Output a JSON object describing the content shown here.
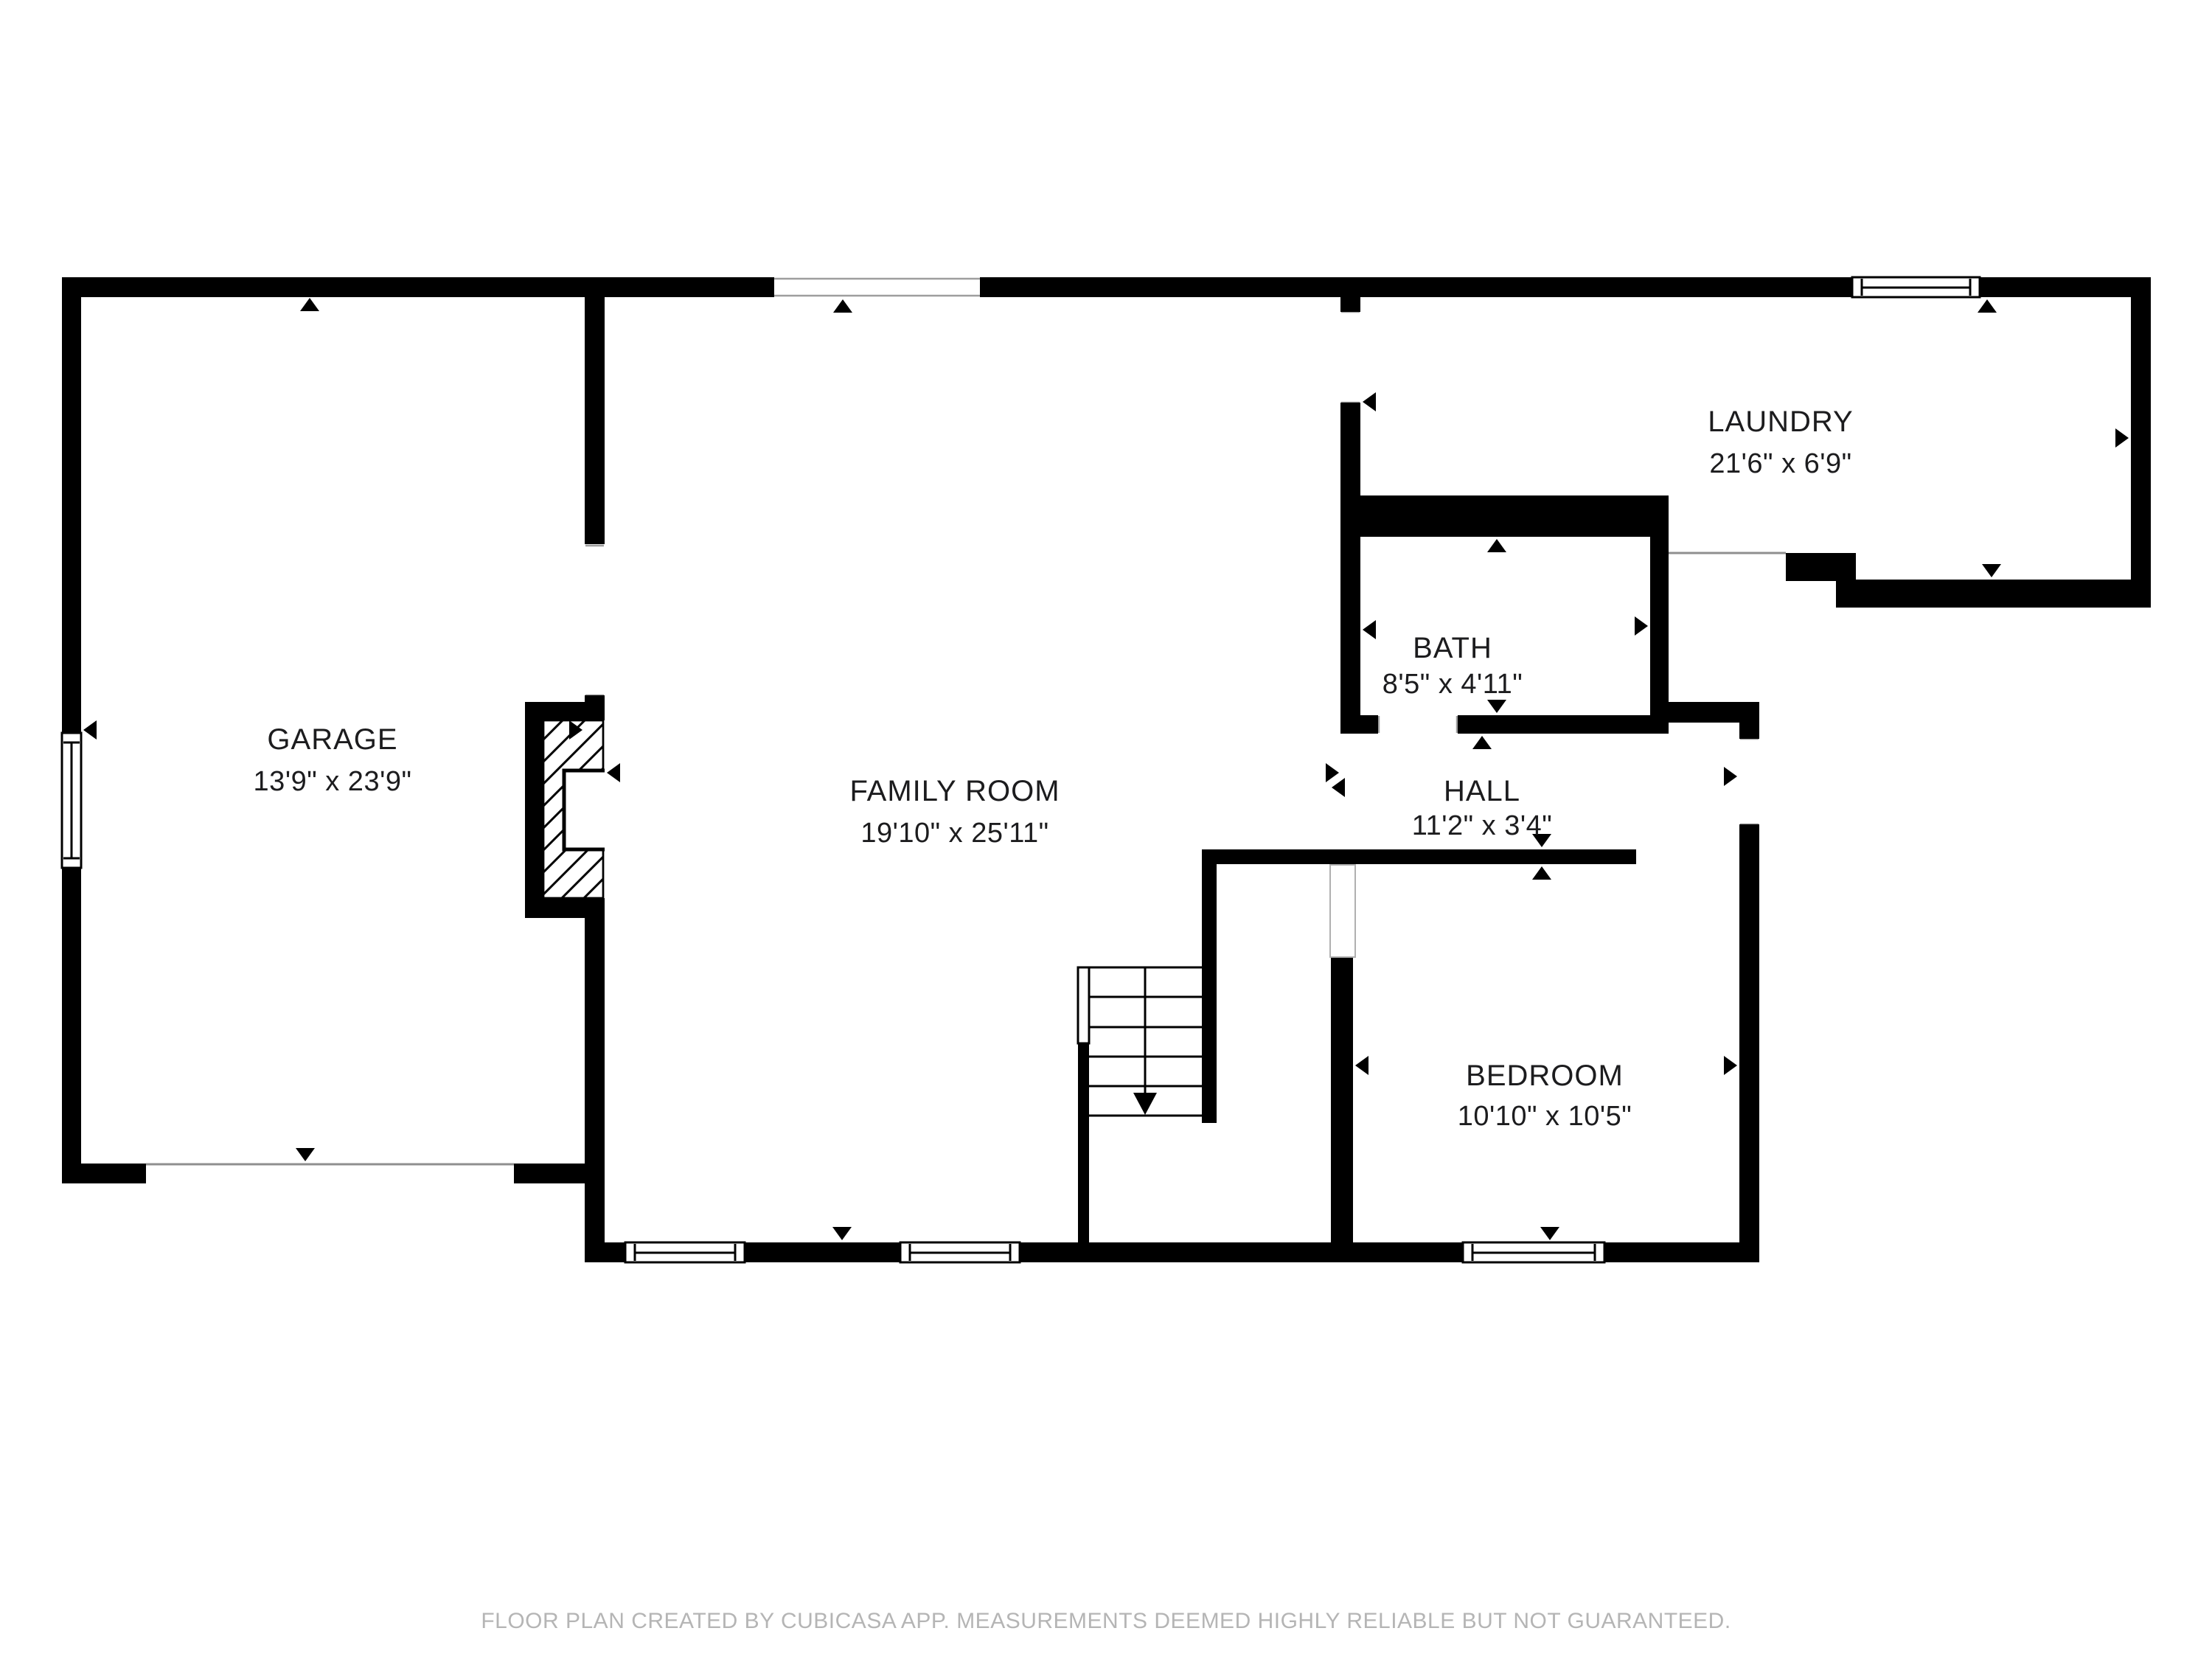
{
  "title": "Floor plan",
  "rooms": [
    {
      "id": "garage",
      "name": "GARAGE",
      "dims": "13'9\" x 23'9\""
    },
    {
      "id": "family-room",
      "name": "FAMILY ROOM",
      "dims": "19'10\" x 25'11\""
    },
    {
      "id": "laundry",
      "name": "LAUNDRY",
      "dims": "21'6\" x 6'9\""
    },
    {
      "id": "bath",
      "name": "BATH",
      "dims": "8'5\" x 4'11\""
    },
    {
      "id": "hall",
      "name": "HALL",
      "dims": "11'2\" x 3'4\""
    },
    {
      "id": "bedroom",
      "name": "BEDROOM",
      "dims": "10'10\" x 10'5\""
    }
  ],
  "features": {
    "stairs": {
      "direction": "down",
      "treads": 5
    },
    "fireplace": {
      "location": "between garage and family room",
      "style": "hatched masonry with open firebox"
    },
    "windows": [
      "garage left wall",
      "laundry top wall",
      "family room bottom wall (two)",
      "bedroom bottom wall"
    ],
    "door_openings": [
      "garage rear (top wall arrow)",
      "garage main door (bottom opening)",
      "garage to family room",
      "family room patio opening (top wall)",
      "family room to laundry",
      "laundry rear exit",
      "bath door",
      "hall exterior door (right wall)",
      "bedroom door"
    ]
  },
  "icons": {
    "measure_marker_icon": "small solid black triangle pointing at measured wall",
    "stairs_down_arrow_icon": "long vertical arrow with solid triangular head pointing down the flight"
  },
  "colors": {
    "wall": "#000000",
    "background": "#ffffff",
    "room_label": "#1c1c1e",
    "opening_line": "#9e9e9e",
    "footer_text": "#b5b5b5"
  },
  "footer": {
    "text": "FLOOR PLAN CREATED BY CUBICASA APP. MEASUREMENTS DEEMED HIGHLY RELIABLE BUT NOT GUARANTEED."
  }
}
